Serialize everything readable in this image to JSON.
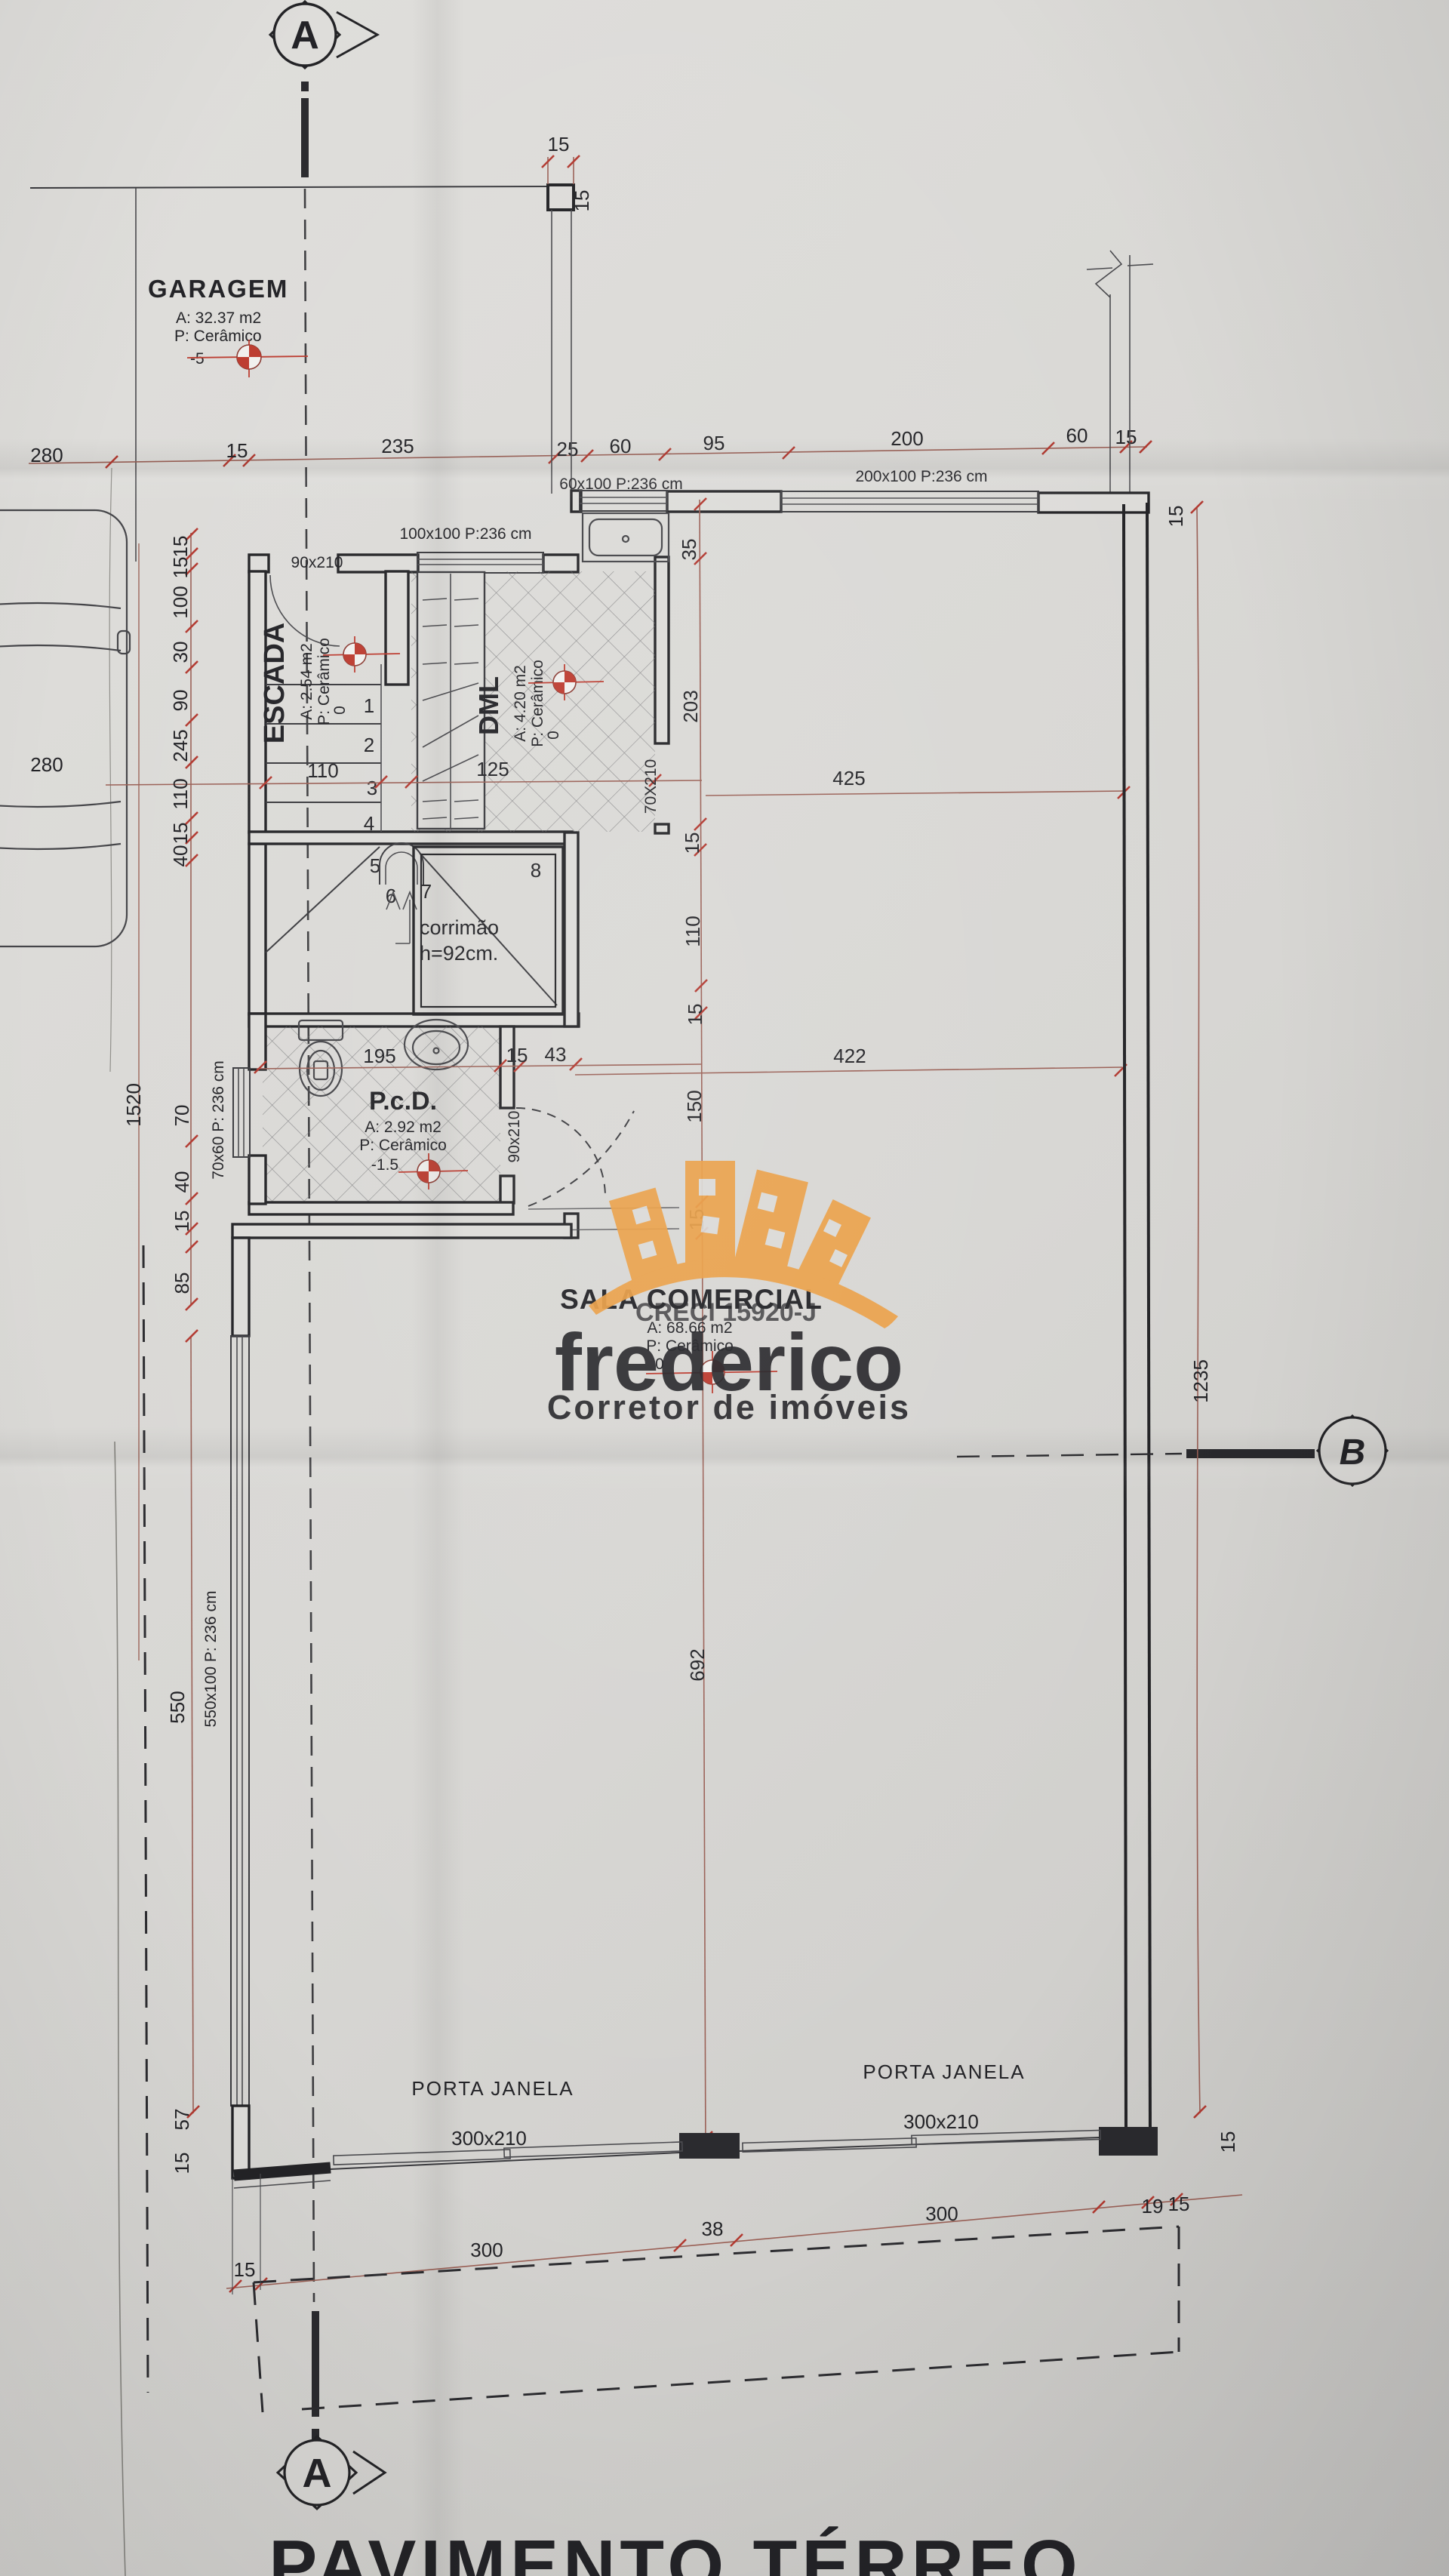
{
  "title": {
    "caption": "PAVIMENTO TÉRREO"
  },
  "markers": {
    "section_a_top": "A",
    "section_a_bottom": "A",
    "section_b": "B"
  },
  "rooms": {
    "garagem": {
      "name": "GARAGEM",
      "area": "A: 32.37 m2",
      "floor": "P: Cerâmico",
      "level": "-5"
    },
    "escada": {
      "name": "ESCADA",
      "area": "A: 2.54 m2",
      "floor": "P: Cerâmico",
      "level": "0"
    },
    "dml": {
      "name": "DML",
      "area": "A: 4.20 m2",
      "floor": "P: Cerâmico",
      "level": "0"
    },
    "pcd": {
      "name": "P.c.D.",
      "area": "A: 2.92 m2",
      "floor": "P: Cerâmico",
      "level": "-1.5"
    },
    "sala": {
      "name": "SALA COMERCIAL",
      "area": "A: 68.66 m2",
      "floor": "P: Cerâmico",
      "level": "0"
    }
  },
  "stair": {
    "corrimao_line1": "corrimão",
    "corrimao_line2": "h=92cm.",
    "treads": [
      "1",
      "2",
      "3",
      "4",
      "5",
      "6",
      "7",
      "8"
    ]
  },
  "openings": {
    "door_escada": "90x210",
    "window_escada_dml": "100x100 P:236 cm",
    "window_60": "60x100 P:236 cm",
    "window_200": "200x100 P:236 cm",
    "door_dml": "70X210",
    "window_pcd": "70x60 P: 236 cm",
    "door_pcd": "90x210",
    "window_sala_left": "550x100 P: 236 cm",
    "porta_janela_1": {
      "name": "PORTA JANELA",
      "size": "300x210"
    },
    "porta_janela_2": {
      "name": "PORTA JANELA",
      "size": "300x210"
    }
  },
  "dims": {
    "top": [
      "280",
      "15",
      "235",
      "25",
      "60",
      "95",
      "200",
      "60",
      "15"
    ],
    "garage_side": "280",
    "top_wall_h": "15",
    "top_wall_v": "15",
    "top_right_v": "15",
    "left": [
      "15",
      "15",
      "100",
      "30",
      "90",
      "245",
      "110",
      "15",
      "40",
      "70",
      "40",
      "15",
      "85"
    ],
    "left_total": "1520",
    "right_inner": [
      "35",
      "203",
      "15",
      "110",
      "15",
      "150",
      "15"
    ],
    "sala_height": "692",
    "right_total": "1235",
    "stair_width": "110",
    "dml_width": "125",
    "corridor_top": "425",
    "corridor_mid": "422",
    "pcd_row": [
      "195",
      "15",
      "43"
    ],
    "window_550": "550",
    "bottom_left_col": [
      "57",
      "15"
    ],
    "bottom": [
      "15",
      "300",
      "38",
      "300",
      "19",
      "15"
    ]
  },
  "watermark": {
    "creci": "CRECI 15920-J",
    "name": "frederico",
    "tagline": "Corretor de imóveis"
  }
}
